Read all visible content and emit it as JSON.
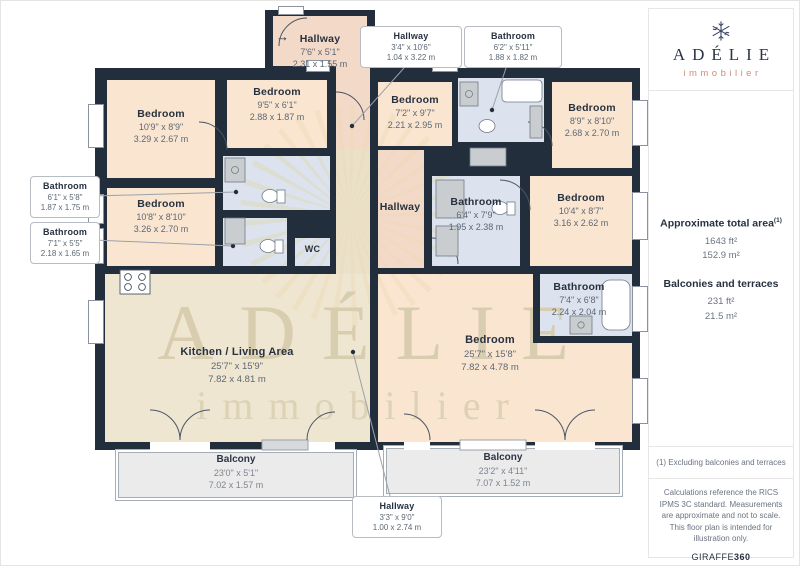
{
  "brand": {
    "name": "ADÉLIE",
    "tagline": "immobilier"
  },
  "sidebar": {
    "total_area_label": "Approximate total area",
    "footnote_marker": "(1)",
    "total_area_ft": "1643 ft²",
    "total_area_m": "152.9 m²",
    "balconies_label": "Balconies and terraces",
    "balconies_ft": "231 ft²",
    "balconies_m": "21.5 m²",
    "footnote": "(1) Excluding balconies and terraces",
    "disclaimer": "Calculations reference the RICS IPMS 3C standard. Measurements are approximate and not to scale. This floor plan is intended for illustration only.",
    "credit_name": "GIRAFFE",
    "credit_suffix": "360"
  },
  "rooms": {
    "hallway_top": {
      "name": "Hallway",
      "imperial": "7'6\" x 5'1\"",
      "metric": "2.31 x 1.55 m"
    },
    "bedroom_tl": {
      "name": "Bedroom",
      "imperial": "10'9\" x 8'9\"",
      "metric": "3.29 x 2.67 m"
    },
    "bedroom_tm": {
      "name": "Bedroom",
      "imperial": "9'5\" x 6'1\"",
      "metric": "2.88 x 1.87 m"
    },
    "bedroom_ml": {
      "name": "Bedroom",
      "imperial": "10'8\" x 8'10\"",
      "metric": "3.26 x 2.70 m"
    },
    "wc": {
      "name": "WC"
    },
    "kitchen_living": {
      "name": "Kitchen / Living Area",
      "imperial": "25'7\" x 15'9\"",
      "metric": "7.82 x 4.81 m"
    },
    "hallway_center": {
      "name": "Hallway"
    },
    "bedroom_tc": {
      "name": "Bedroom",
      "imperial": "7'2\" x 9'7\"",
      "metric": "2.21 x 2.95 m"
    },
    "bedroom_tr": {
      "name": "Bedroom",
      "imperial": "8'9\" x 8'10\"",
      "metric": "2.68 x 2.70 m"
    },
    "bathroom_center": {
      "name": "Bathroom",
      "imperial": "6'4\" x 7'9\"",
      "metric": "1.95 x 2.38 m"
    },
    "bedroom_r": {
      "name": "Bedroom",
      "imperial": "10'4\" x 8'7\"",
      "metric": "3.16 x 2.62 m"
    },
    "bathroom_r": {
      "name": "Bathroom",
      "imperial": "7'4\" x 6'8\"",
      "metric": "2.24 x 2.04 m"
    },
    "bedroom_br": {
      "name": "Bedroom",
      "imperial": "25'7\" x 15'8\"",
      "metric": "7.82 x 4.78 m"
    },
    "balcony_l": {
      "name": "Balcony",
      "imperial": "23'0\" x 5'1\"",
      "metric": "7.02 x 1.57 m"
    },
    "balcony_r": {
      "name": "Balcony",
      "imperial": "23'2\" x 4'11\"",
      "metric": "7.07 x 1.52 m"
    }
  },
  "callouts": {
    "hallway_top": {
      "name": "Hallway",
      "imperial": "3'4\" x 10'6\"",
      "metric": "1.04 x 3.22 m"
    },
    "bathroom_top": {
      "name": "Bathroom",
      "imperial": "6'2\" x 5'11\"",
      "metric": "1.88 x 1.82 m"
    },
    "bathroom_l1": {
      "name": "Bathroom",
      "imperial": "6'1\" x 5'8\"",
      "metric": "1.87 x 1.75 m"
    },
    "bathroom_l2": {
      "name": "Bathroom",
      "imperial": "7'1\" x 5'5\"",
      "metric": "2.18 x 1.65 m"
    },
    "hallway_bottom": {
      "name": "Hallway",
      "imperial": "3'3\" x 9'0\"",
      "metric": "1.00 x 2.74 m"
    }
  },
  "watermark": {
    "name": "ADÉLIE",
    "tagline": "immobilier"
  },
  "entry_arrow": "→",
  "colors": {
    "walls": "#232e3c",
    "bedroom_fill": "#fae6d0",
    "hallway_fill": "#f3d9c7",
    "bathroom_fill": "#dce2ee",
    "living_fill": "#eee6d0",
    "balcony_fill": "#ebebeb",
    "brand_coral": "#cf8d79",
    "text_navy": "#27313f",
    "dim_grey": "#5d6875"
  }
}
